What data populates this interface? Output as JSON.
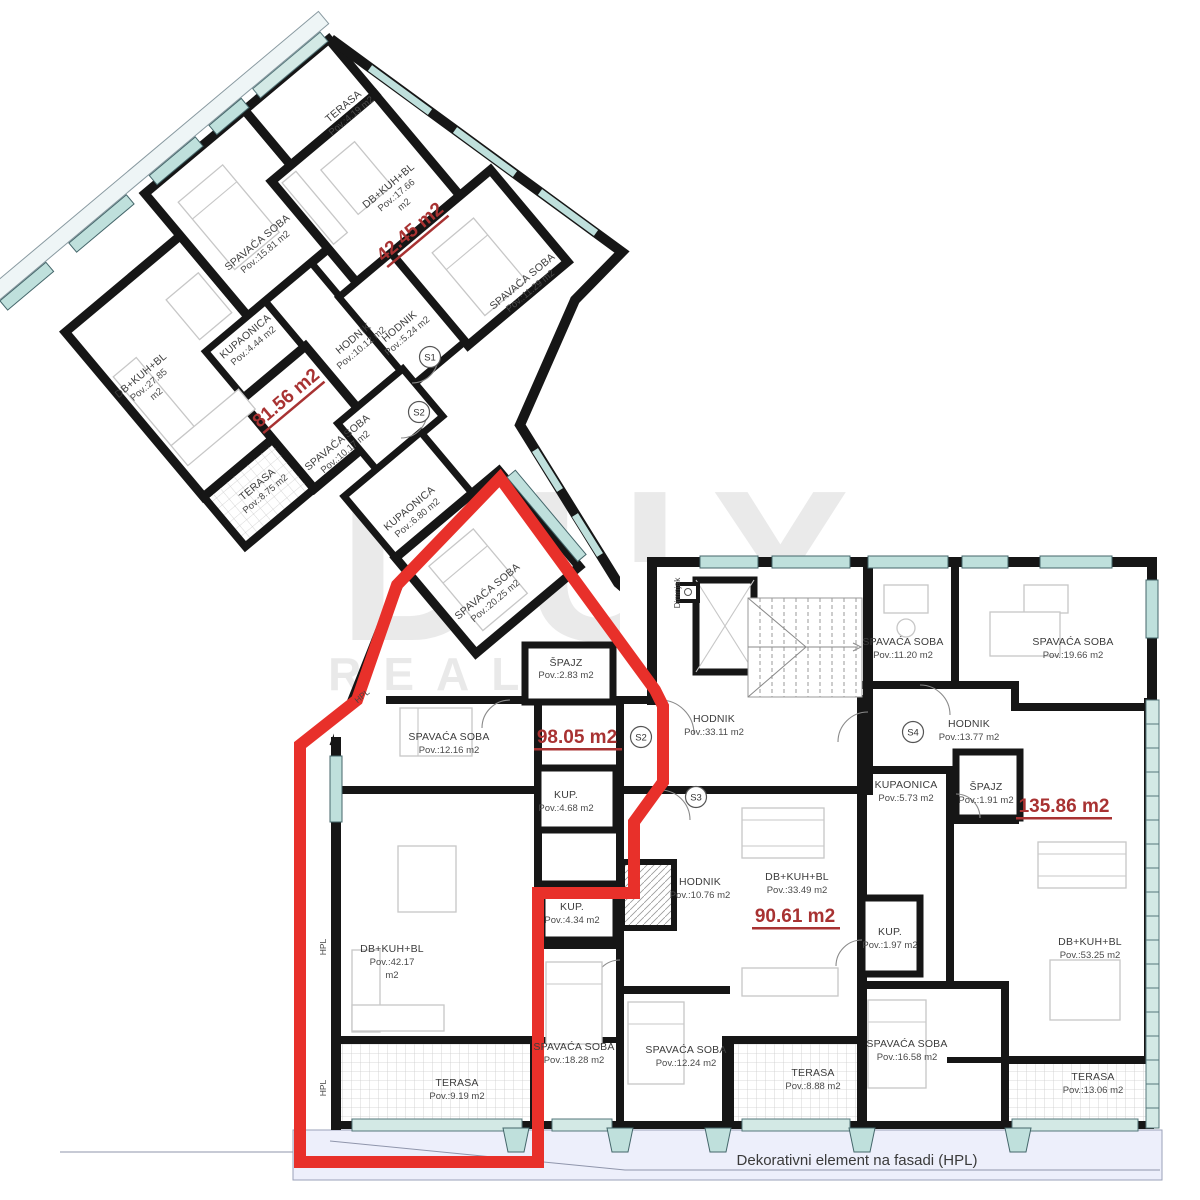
{
  "plan": {
    "watermark": {
      "line1": "DUX",
      "line2": "REAL ESTATE"
    },
    "footer_note": "Dekorativni element na fasadi (HPL)",
    "facade": {
      "hpl": "HPL",
      "chimney": "Dimnjak"
    },
    "colors": {
      "accent_red": "#e8302a",
      "area_text": "#a83232",
      "window_teal": "#bfe0dc",
      "ground": "#edeffb",
      "wall_black": "#161616"
    },
    "units": {
      "s1": "S1",
      "s2": "S2",
      "s3": "S3",
      "s4": "S4"
    },
    "areas": {
      "a4245": "42.45 m2",
      "a8156": "81.56 m2",
      "a9805": "98.05 m2",
      "a9061": "90.61 m2",
      "a13586": "135.86 m2"
    },
    "rooms": {
      "terasa419": {
        "name": "TERASA",
        "pov": "Pov.:4.19 m2"
      },
      "db1766": {
        "name": "DB+KUH+BL",
        "pov": "Pov.:17.66",
        "unit": "m2"
      },
      "spav1129": {
        "name": "SPAVAĆA SOBA",
        "pov": "Pov.:11.29 m2"
      },
      "hodnik524": {
        "name": "HODNIK",
        "pov": "Pov.:5.24 m2"
      },
      "hodnik1012": {
        "name": "HODNIK",
        "pov": "Pov.:10.12 m2"
      },
      "spav1581": {
        "name": "SPAVAĆA SOBA",
        "pov": "Pov.:15.81 m2"
      },
      "kupa444": {
        "name": "KUPAONICA",
        "pov": "Pov.:4.44 m2"
      },
      "db2785": {
        "name": "DB+KUH+BL",
        "pov": "Pov.:27.85",
        "unit": "m2"
      },
      "spav1017": {
        "name": "SPAVAĆA SOBA",
        "pov": "Pov.:10.17 m2"
      },
      "terasa875": {
        "name": "TERASA",
        "pov": "Pov.:8.75 m2"
      },
      "kupa680": {
        "name": "KUPAONICA",
        "pov": "Pov.:6.80 m2"
      },
      "spav2025": {
        "name": "SPAVAĆA SOBA",
        "pov": "Pov.:20.25 m2"
      },
      "spajz283": {
        "name": "ŠPAJZ",
        "pov": "Pov.:2.83 m2"
      },
      "hodnik3311": {
        "name": "HODNIK",
        "pov": "Pov.:33.11 m2"
      },
      "spav1216": {
        "name": "SPAVAĆA SOBA",
        "pov": "Pov.:12.16 m2"
      },
      "kup468": {
        "name": "KUP.",
        "pov": "Pov.:4.68 m2"
      },
      "kup434": {
        "name": "KUP.",
        "pov": "Pov.:4.34 m2"
      },
      "hodnik1076": {
        "name": "HODNIK",
        "pov": "Pov.:10.76 m2"
      },
      "db4217": {
        "name": "DB+KUH+BL",
        "pov": "Pov.:42.17",
        "unit": "m2"
      },
      "terasa919": {
        "name": "TERASA",
        "pov": "Pov.:9.19 m2"
      },
      "spav1828": {
        "name": "SPAVAĆA SOBA",
        "pov": "Pov.:18.28 m2"
      },
      "spav1224": {
        "name": "SPAVAĆA SOBA",
        "pov": "Pov.:12.24 m2"
      },
      "db3349": {
        "name": "DB+KUH+BL",
        "pov": "Pov.:33.49 m2"
      },
      "terasa888": {
        "name": "TERASA",
        "pov": "Pov.:8.88 m2"
      },
      "spav1120": {
        "name": "SPAVAĆA SOBA",
        "pov": "Pov.:11.20 m2"
      },
      "spav1966": {
        "name": "SPAVAĆA SOBA",
        "pov": "Pov.:19.66 m2"
      },
      "hodnik1377": {
        "name": "HODNIK",
        "pov": "Pov.:13.77 m2"
      },
      "kupa573": {
        "name": "KUPAONICA",
        "pov": "Pov.:5.73 m2"
      },
      "spajz191": {
        "name": "ŠPAJZ",
        "pov": "Pov.:1.91 m2"
      },
      "kup197": {
        "name": "KUP.",
        "pov": "Pov.:1.97 m2"
      },
      "spav1658": {
        "name": "SPAVAĆA SOBA",
        "pov": "Pov.:16.58 m2"
      },
      "db5325": {
        "name": "DB+KUH+BL",
        "pov": "Pov.:53.25 m2"
      },
      "terasa1306": {
        "name": "TERASA",
        "pov": "Pov.:13.06 m2"
      }
    }
  }
}
